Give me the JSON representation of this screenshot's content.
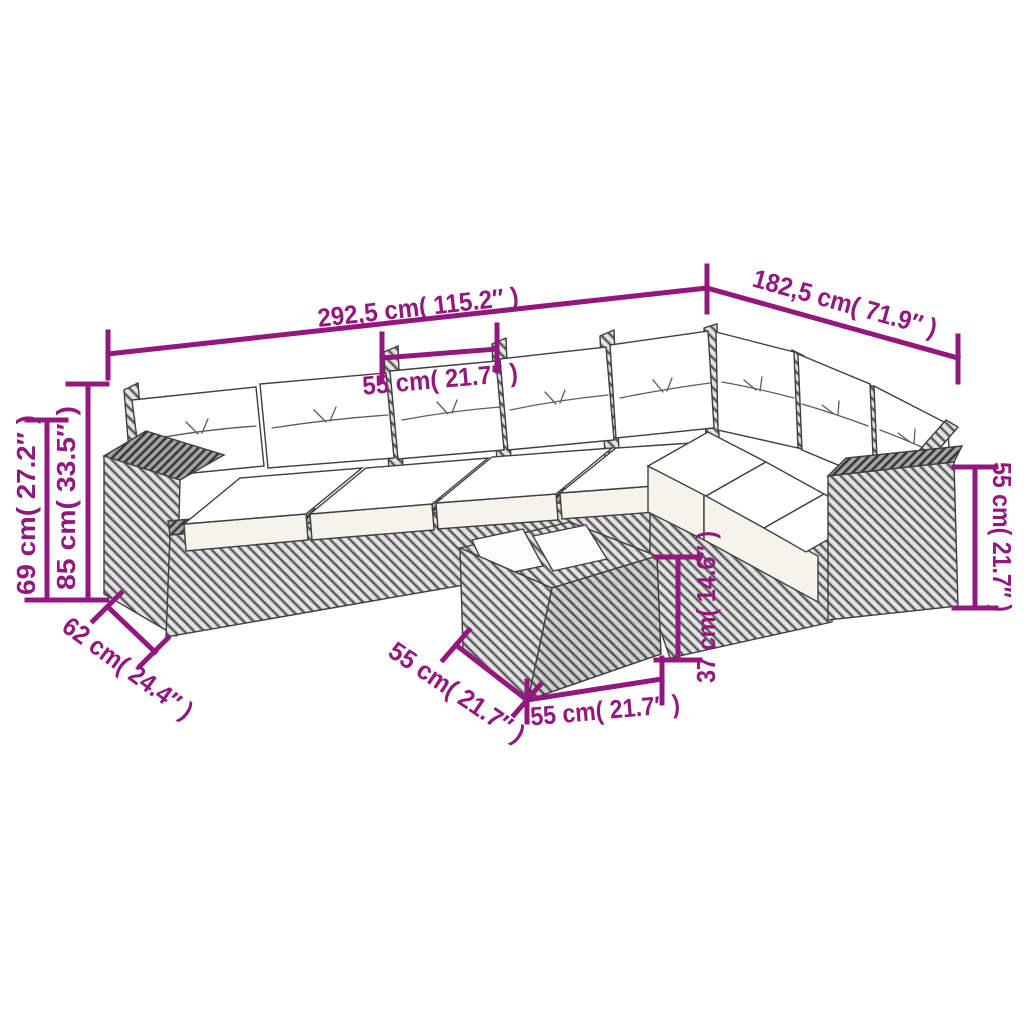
{
  "palette": {
    "dimension_color": "#93187E",
    "outline_color": "#3f3f3f",
    "rattan_base": "#cfcfcf",
    "rattan_dark_line": "#565656",
    "cushion_fill": "#ffffff",
    "cushion_front_fill": "#f6f3ea",
    "background": "#ffffff"
  },
  "dimensions": {
    "sofa_total_length": {
      "label": "292,5 cm( 115.2″ )"
    },
    "sofa_total_depth": {
      "label": "182,5 cm( 71.9″ )"
    },
    "seat_module_width": {
      "label": "55 cm( 21.7″ )"
    },
    "seat_height": {
      "label": "69 cm( 27.2″ )"
    },
    "backrest_height": {
      "label": "85 cm( 33.5″ )"
    },
    "seat_depth": {
      "label": "62 cm( 24.4″ )"
    },
    "table_height": {
      "label": "37 cm( 14.6″ )"
    },
    "table_depth": {
      "label": "55 cm( 21.7″ )"
    },
    "table_width": {
      "label": "55 cm( 21.7″ )"
    },
    "armrest_height": {
      "label": "55 cm( 21.7″ )"
    }
  }
}
